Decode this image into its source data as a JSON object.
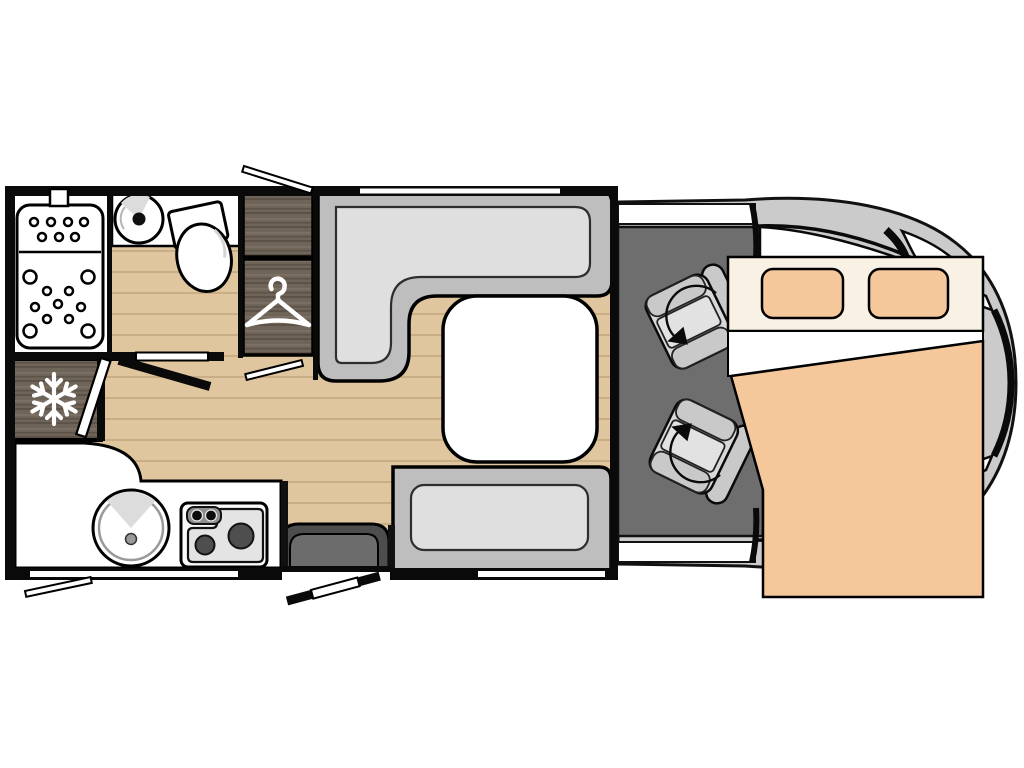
{
  "plan": {
    "kind": "motorhome-floorplan-top-view",
    "icons": {
      "freezer": "snowflake-icon",
      "wardrobe": "hanger-icon",
      "cab_seats": "swivel-arrow-icon"
    }
  },
  "colors": {
    "background": "#ffffff",
    "wall_black": "#0a0a0a",
    "outline": "#111111",
    "floor_wood": "#e0c69e",
    "floor_wood_line": "#c9ae85",
    "dark_wood": "#6f6458",
    "dark_wood_line": "#5c5248",
    "dark_wood_light": "#7e7266",
    "white_fixture": "#ffffff",
    "light_shade": "#dcdcdc",
    "mid_gray": "#9a9a9a",
    "seat_base_gray": "#bebebe",
    "seat_cushion_gray": "#dfdfdf",
    "cab_floor_gray": "#6e6e6e",
    "vehicle_body_gray": "#cbcbcb",
    "cab_seat_pad": "#d8d8d8",
    "cab_seat_bolster": "#c9c9c9",
    "cab_seat_center": "#e2e2e2",
    "bed_header_cream": "#faf1e5",
    "bed_orange": "#f5c89c",
    "step_dark": "#4d4d4d",
    "step_inner": "#6c6c6c",
    "stove_body": "#fbfbfb",
    "stove_plate": "#e4e4e4",
    "stove_panel": "#8f8f8f",
    "burner_dark": "#4e4e4e",
    "icon_white": "#ffffff"
  }
}
